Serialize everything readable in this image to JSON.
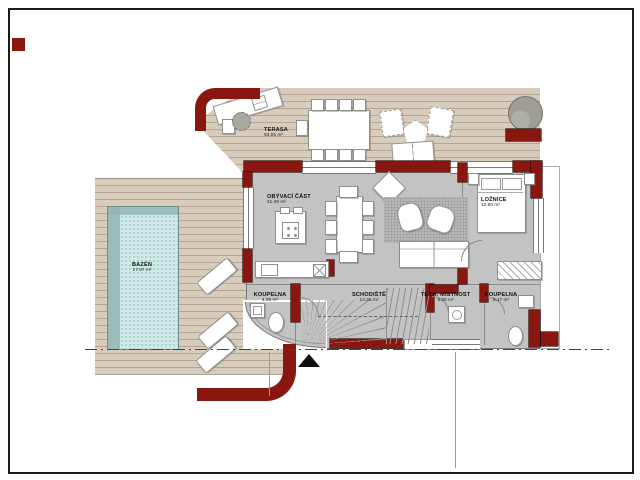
{
  "plan": {
    "type": "floor-plan",
    "language": "cs",
    "rooms": [
      {
        "id": "terasa",
        "name": "TERASA",
        "area": "93.05 m²"
      },
      {
        "id": "obyvaci",
        "name": "OBÝVACÍ ČÁST",
        "area": "41.49 m²"
      },
      {
        "id": "loznice",
        "name": "LOŽNICE",
        "area": "12.80 m²"
      },
      {
        "id": "bazen",
        "name": "BAZÉN",
        "area": "17.97 m²"
      },
      {
        "id": "koupelna1",
        "name": "KOUPELNA",
        "area": "4.08 m²"
      },
      {
        "id": "schodiste",
        "name": "SCHODIŠTĚ",
        "area": "14.26 m²"
      },
      {
        "id": "tech",
        "name": "TECH. MÍSTNOST",
        "area": "5.06 m²"
      },
      {
        "id": "koupelna2",
        "name": "KOUPELNA",
        "area": "5.17 m²"
      }
    ],
    "colors": {
      "wall": "#8a170f",
      "deck": "#d8ccbd",
      "pool_water": "#cfe9e7",
      "floor": "#c3c3c3",
      "background": "#ffffff"
    },
    "icons": [
      "north-arrow-icon",
      "tree-icon"
    ]
  }
}
